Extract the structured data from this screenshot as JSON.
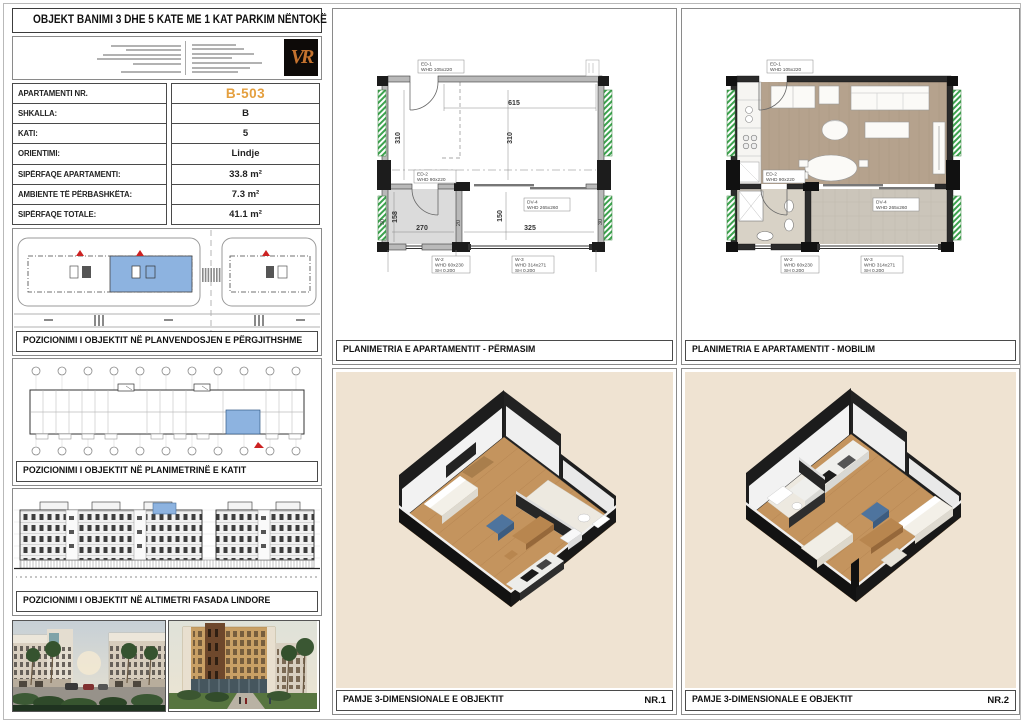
{
  "title": "OBJEKT BANIMI 3 DHE 5 KATE ME 1 KAT PARKIM NËNTOKË",
  "logo": {
    "monogram": "VR"
  },
  "apartment": {
    "rows": [
      {
        "label": "APARTAMENTI NR.",
        "value": "B-503"
      },
      {
        "label": "SHKALLA:",
        "value": "B"
      },
      {
        "label": "KATI:",
        "value": "5"
      },
      {
        "label": "ORIENTIMI:",
        "value": "Lindje"
      },
      {
        "label": "SIPËRFAQE APARTAMENTI:",
        "value": "33.8 m²"
      },
      {
        "label": "AMBIENTE TË PËRBASHKËTA:",
        "value": "7.3 m²"
      },
      {
        "label": "SIPËRFAQE TOTALE:",
        "value": "41.1 m²"
      }
    ]
  },
  "captions": {
    "site_plan": "POZICIONIMI I OBJEKTIT NË PLANVENDOSJEN E PËRGJITHSHME",
    "floor_plan": "POZICIONIMI I OBJEKTIT NË PLANIMETRINË E KATIT",
    "elevation": "POZICIONIMI I OBJEKTIT NË ALTIMETRI FASADA LINDORE",
    "plan_dimensions": "PLANIMETRIA E APARTAMENTIT - PËRMASIM",
    "plan_furnished": "PLANIMETRIA E APARTAMENTIT - MOBILIM",
    "view_3d": "PAMJE 3-DIMENSIONALE E OBJEKTIT",
    "view_3d_nr1": "NR.1",
    "view_3d_nr2": "NR.2"
  },
  "plan": {
    "dims": {
      "top_width": "615",
      "room_h_left": "310",
      "room_h_mid": "310",
      "hall_h": "158",
      "hall_w": "270",
      "wall_t": "20",
      "low_room_h": "150",
      "low_room_w": "325",
      "wall_l": "30",
      "wall_r": "30"
    },
    "openings": {
      "ed1": {
        "code": "ED-1",
        "size": "WHD 105x220"
      },
      "ed2": {
        "code": "ED-2",
        "size": "WHD 90x220"
      },
      "dv4": {
        "code": "DV-4",
        "size": "WHD 265x260"
      },
      "w2": {
        "code": "W-2",
        "size": "WHD 60x230",
        "sill": "SH   0.200"
      },
      "w3": {
        "code": "W-3",
        "size": "WHD 314x271",
        "sill": "SH   0.200"
      }
    }
  },
  "colors": {
    "accent_orange": "#E49F3E",
    "highlight_blue": "#8DB3E0",
    "insulation_green": "#3DA34F",
    "beige_bg": "#EFE3D2"
  }
}
